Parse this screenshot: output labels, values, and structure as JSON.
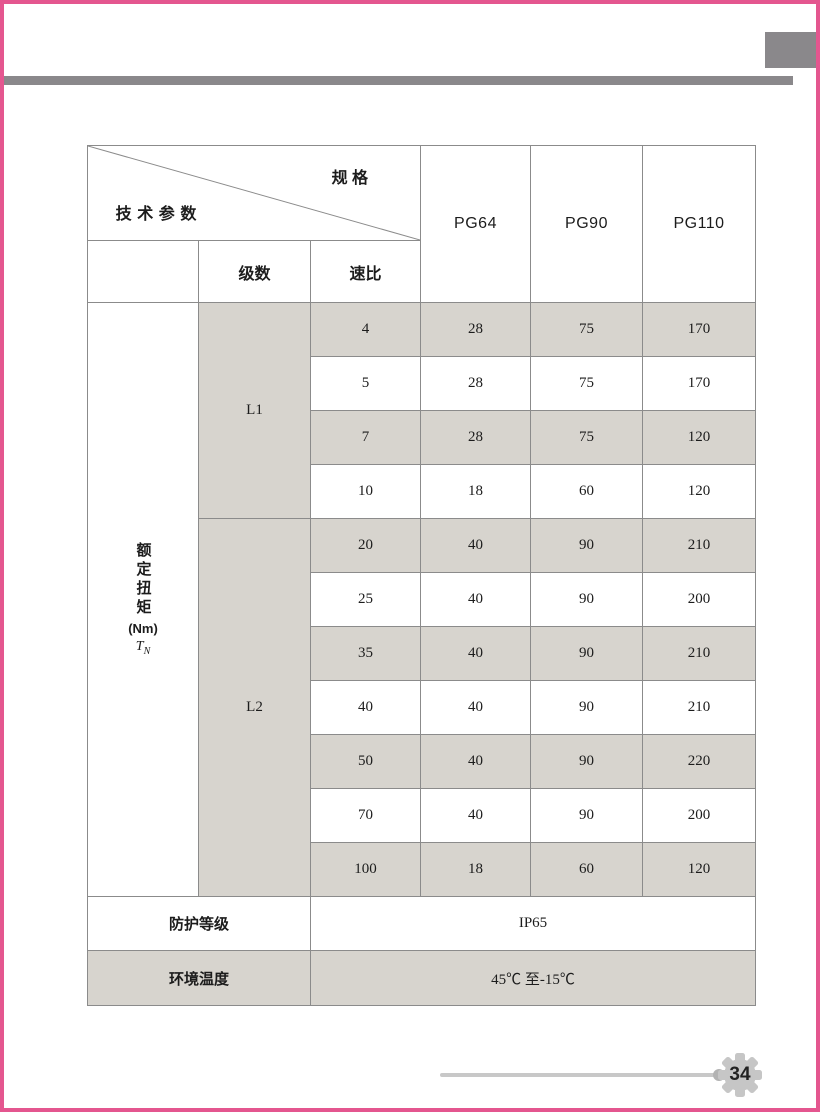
{
  "page": {
    "number": "34",
    "colors": {
      "frame_pink": "#e4568f",
      "bar_gray": "#8a888b",
      "row_shade": "#d7d4ce",
      "grid_line": "#8b8b8b",
      "footer_line": "#c8c8c8",
      "gear_fill": "#c6c6c6"
    }
  },
  "table": {
    "header": {
      "diagonal_top": "规 格",
      "diagonal_bottom": "技术参数",
      "col_stage": "级数",
      "col_ratio": "速比",
      "models": [
        "PG64",
        "PG90",
        "PG110"
      ]
    },
    "torque_label": {
      "vertical_text": "额定扭矩",
      "unit": "(Nm)",
      "symbol": "T",
      "symbol_sub": "N"
    },
    "groups": [
      {
        "stage": "L1",
        "rows": [
          {
            "ratio": "4",
            "values": [
              "28",
              "75",
              "170"
            ],
            "shaded": true
          },
          {
            "ratio": "5",
            "values": [
              "28",
              "75",
              "170"
            ],
            "shaded": false
          },
          {
            "ratio": "7",
            "values": [
              "28",
              "75",
              "120"
            ],
            "shaded": true
          },
          {
            "ratio": "10",
            "values": [
              "18",
              "60",
              "120"
            ],
            "shaded": false
          }
        ]
      },
      {
        "stage": "L2",
        "rows": [
          {
            "ratio": "20",
            "values": [
              "40",
              "90",
              "210"
            ],
            "shaded": true
          },
          {
            "ratio": "25",
            "values": [
              "40",
              "90",
              "200"
            ],
            "shaded": false
          },
          {
            "ratio": "35",
            "values": [
              "40",
              "90",
              "210"
            ],
            "shaded": true
          },
          {
            "ratio": "40",
            "values": [
              "40",
              "90",
              "210"
            ],
            "shaded": false
          },
          {
            "ratio": "50",
            "values": [
              "40",
              "90",
              "220"
            ],
            "shaded": true
          },
          {
            "ratio": "70",
            "values": [
              "40",
              "90",
              "200"
            ],
            "shaded": false
          },
          {
            "ratio": "100",
            "values": [
              "18",
              "60",
              "120"
            ],
            "shaded": true
          }
        ]
      }
    ],
    "footer_rows": [
      {
        "label": "防护等级",
        "value": "IP65",
        "shaded": false
      },
      {
        "label": "环境温度",
        "value": "45℃ 至-15℃",
        "shaded": true
      }
    ]
  }
}
